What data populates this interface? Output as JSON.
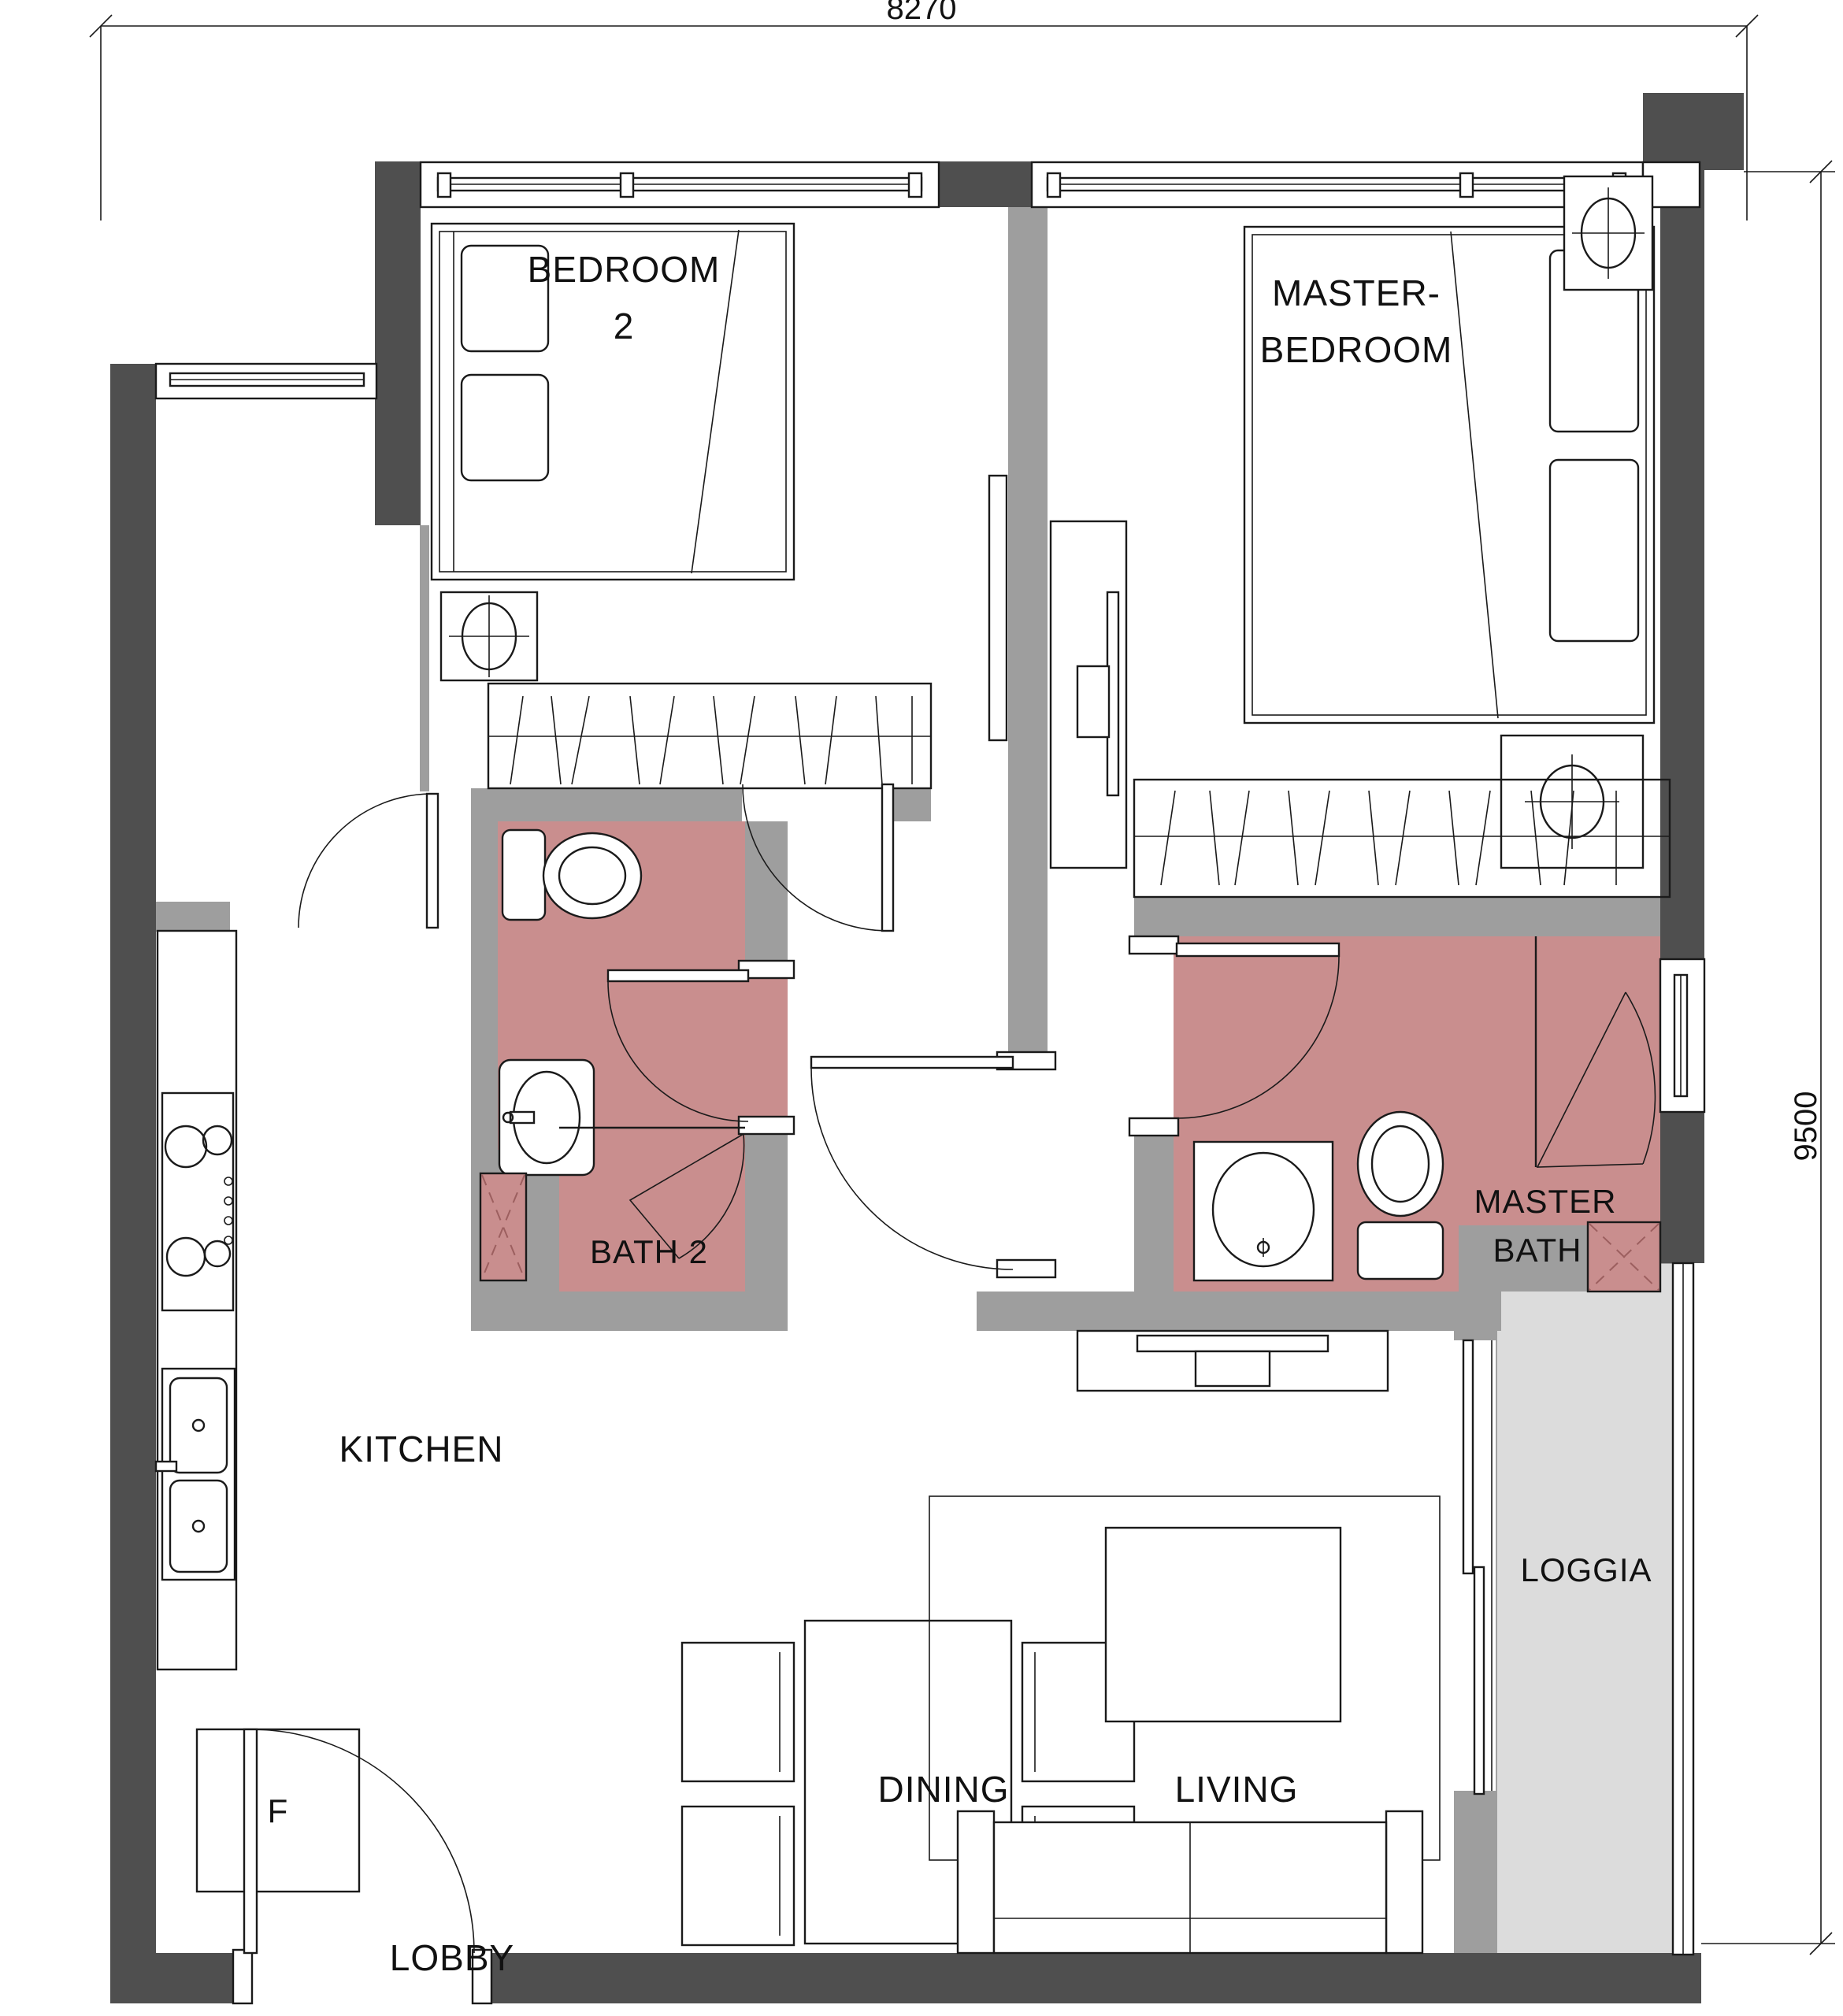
{
  "drawing": {
    "type": "apartment-floor-plan",
    "dimensions": {
      "width_label": "8270",
      "height_label": "9500"
    },
    "rooms": {
      "bedroom2": {
        "line1": "BEDROOM",
        "line2": "2"
      },
      "master_bedroom": {
        "line1": "MASTER-",
        "line2": "BEDROOM"
      },
      "bath2": {
        "label": "BATH 2"
      },
      "master_bath": {
        "line1": "MASTER",
        "line2": "BATH"
      },
      "kitchen": {
        "label": "KITCHEN"
      },
      "dining": {
        "label": "DINING"
      },
      "living": {
        "label": "LIVING"
      },
      "loggia": {
        "label": "LOGGIA"
      },
      "lobby": {
        "label": "LOBBY"
      },
      "fridge": {
        "label": "F"
      }
    }
  },
  "colors": {
    "wall_dark": "#4f4f4f",
    "wall_light": "#9e9e9e",
    "bath_fill": "#c98e8e",
    "loggia_fill": "#dcdcdc",
    "line_color": "#1a1a1a"
  }
}
